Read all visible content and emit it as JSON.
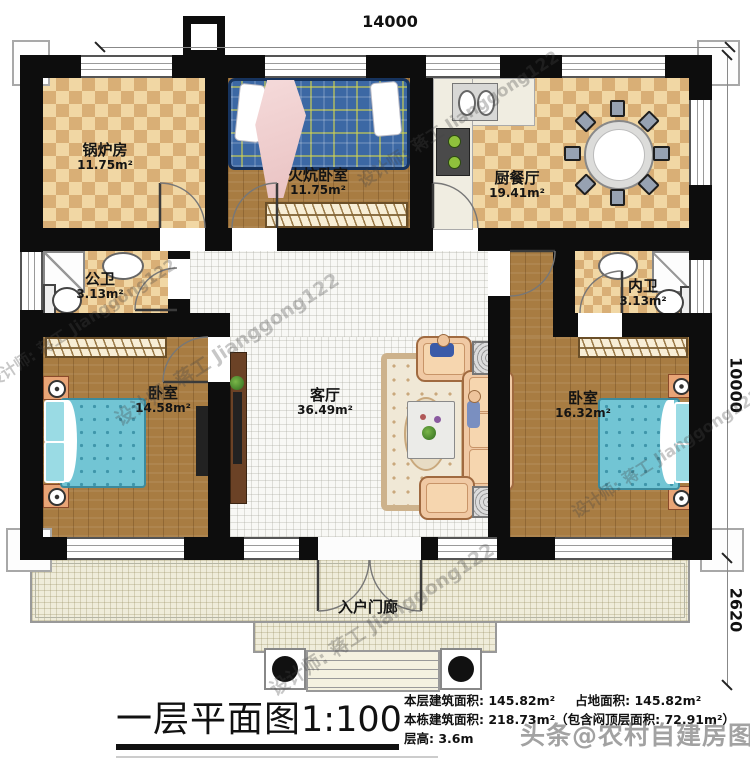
{
  "plan": {
    "title": "一层平面图",
    "scale": "1:100",
    "dimensions": {
      "width_top": "14000",
      "height_main": "10000",
      "height_porch": "2620"
    },
    "rooms": [
      {
        "name": "锅炉房",
        "area": "11.75m²"
      },
      {
        "name": "火炕卧室",
        "area": "11.75m²"
      },
      {
        "name": "厨餐厅",
        "area": "19.41m²"
      },
      {
        "name": "公卫",
        "area": "3.13m²"
      },
      {
        "name": "内卫",
        "area": "3.13m²"
      },
      {
        "name": "卧室",
        "area": "14.58m²"
      },
      {
        "name": "客厅",
        "area": "36.49m²"
      },
      {
        "name": "卧室",
        "area": "16.32m²"
      }
    ],
    "porch_label": "入户门廊",
    "stats": {
      "line1a": "本层建筑面积: 145.82m²",
      "line1b": "占地面积: 145.82m²",
      "line2": "本栋建筑面积: 218.73m²（包含闷顶层面积: 72.91m²）",
      "line3": "层高: 3.6m"
    },
    "watermarks": {
      "designer": "设计师: 蒋工 Jianggong122",
      "footer": "头条@农村自建房图纸"
    },
    "colors": {
      "wall": "#0d0d0d",
      "tile_tan_light": "#f1d7a4",
      "tile_tan_dark": "#d9af76",
      "wood_floor": "#a87c42",
      "living_tile": "#f8f8f5",
      "porch_floor": "#efecda",
      "kang_blue": "#3c68a4",
      "bed_cyan": "#72c5d4",
      "sofa_peach": "#f0c9a4",
      "nightstand_orange": "#e8a476"
    }
  }
}
